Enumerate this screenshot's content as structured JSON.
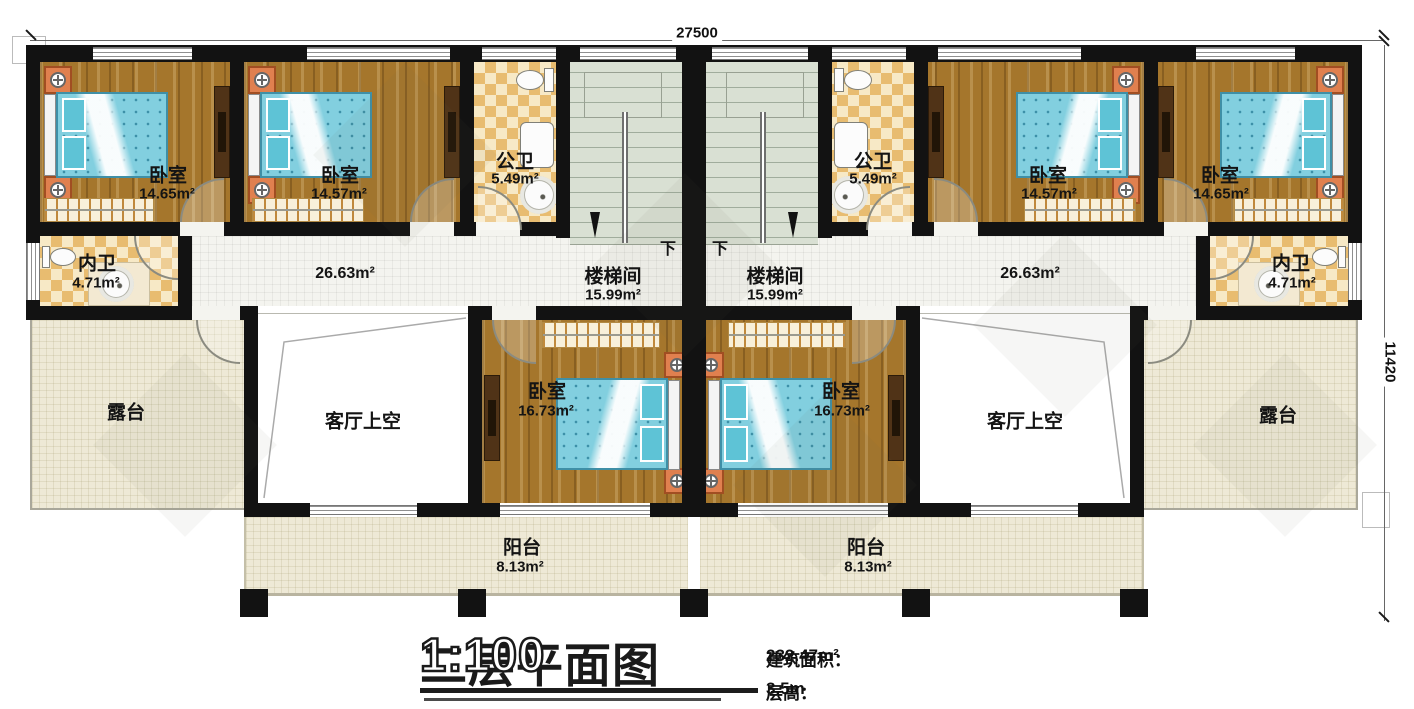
{
  "annotations": {
    "top_dimension": "27500",
    "right_dimension": "11420",
    "stairs_down": "下"
  },
  "rooms": {
    "bedroom_a": {
      "name": "卧室",
      "area": "14.65m²"
    },
    "bedroom_b": {
      "name": "卧室",
      "area": "14.57m²"
    },
    "public_bath": {
      "name": "公卫",
      "area": "5.49m²"
    },
    "stairwell": {
      "name": "楼梯间",
      "area": "15.99m²"
    },
    "inner_bath": {
      "name": "内卫",
      "area": "4.71m²"
    },
    "corridor": {
      "area": "26.63m²"
    },
    "master_bedroom": {
      "name": "卧室",
      "area": "16.73m²"
    },
    "living_void": {
      "name": "客厅上空"
    },
    "terrace": {
      "name": "露台"
    },
    "balcony": {
      "name": "阳台",
      "area": "8.13m²"
    }
  },
  "title_block": {
    "title": "二层平面图",
    "scale": "1:100",
    "building_area_label": "建筑面积：",
    "building_area_value": "232.47m²",
    "floor_height_label": "层高：",
    "floor_height_value": "3.5m"
  },
  "colors": {
    "wall": "#121212",
    "wood_floor": "#a5762c",
    "tile_dark": "#e8bc70",
    "tile_light": "#f7e9c6",
    "stair_floor": "#d9e0d3",
    "corridor_floor": "#f4f4ef",
    "terrace_floor": "#eee9d6",
    "bed_blue": "#82cfdf",
    "nightstand_orange": "#e0804f"
  }
}
